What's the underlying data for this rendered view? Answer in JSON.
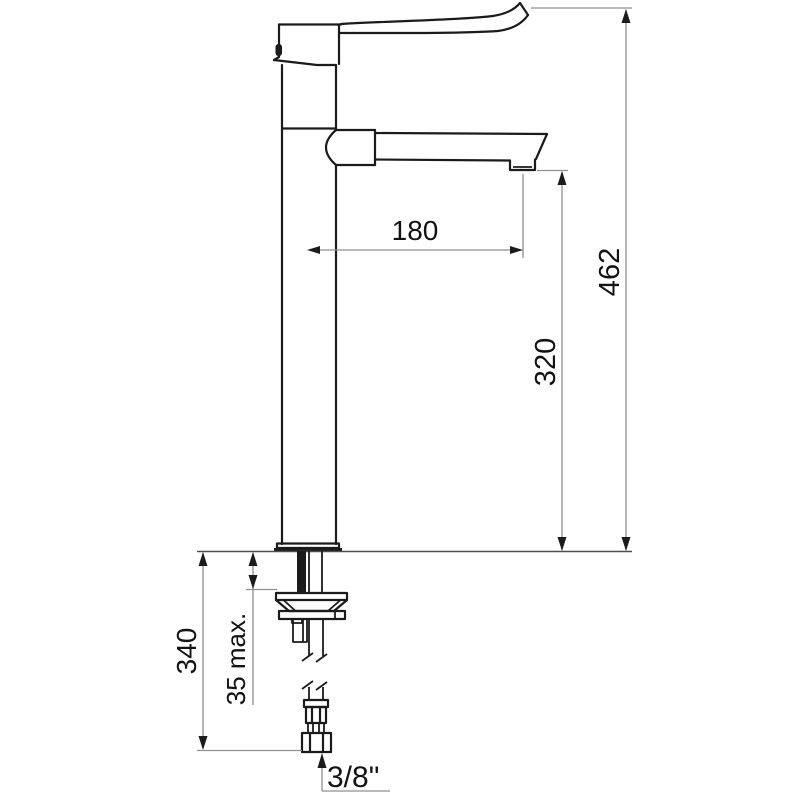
{
  "drawing": {
    "dimensions": {
      "spout_reach": "180",
      "overall_height": "462",
      "outlet_height": "320",
      "under_deck_length": "340",
      "deck_thickness_max": "35 max.",
      "supply_connection": "3/8\""
    },
    "colors": {
      "object_line": "#1b1b1b",
      "dimension_line": "#8f8f8f",
      "deck_line": "#4d4d4d",
      "background": "#ffffff",
      "text": "#131313"
    }
  }
}
